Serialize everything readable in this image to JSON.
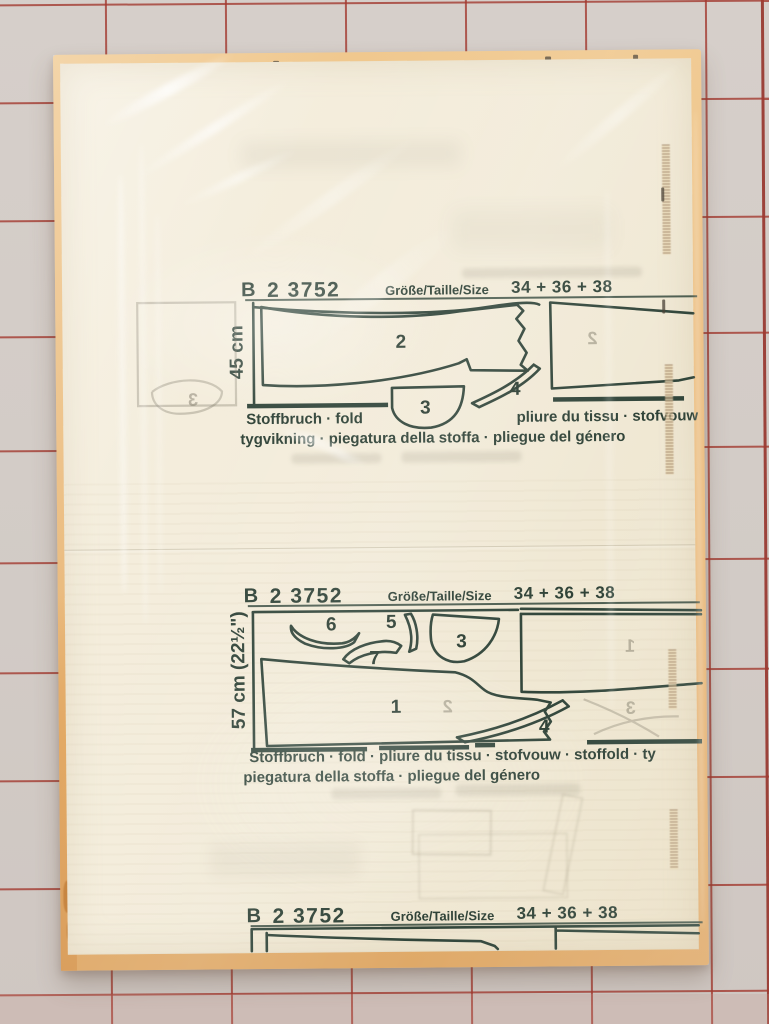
{
  "header": {
    "brand": "B",
    "number": "2 3752",
    "size_label": "Größe/Taille/Size",
    "sizes": "34 + 36 + 38"
  },
  "section_45": {
    "length": "45 cm",
    "fold_left": "Stoffbruch · fold",
    "fold_right": "pliure du tissu · stofvouw",
    "fold_line2": "tygvikning · piegatura della stoffa · pliegue del género",
    "pieces": {
      "p2": "2",
      "p3": "3",
      "p4": "4"
    },
    "ghosts": {
      "g3": "3",
      "g2": "2"
    }
  },
  "section_57": {
    "length": "57 cm (22½\")",
    "fold_line1": "Stoffbruch · fold · pliure du tissu · stofvouw · stoffold · ty",
    "fold_line2": "piegatura della stoffa · pliegue del género",
    "pieces": {
      "p1": "1",
      "p3": "3",
      "p4": "4",
      "p5": "5",
      "p6": "6",
      "p7": "7"
    },
    "ghosts": {
      "g1": "1",
      "g2": "2",
      "g3": "3"
    }
  },
  "colors": {
    "print_ink": "#2f4237",
    "mat": "#d2cbc6",
    "mat_line": "#a23a30",
    "cardboard": "#eaba7c",
    "paper": "#f3ecda"
  }
}
